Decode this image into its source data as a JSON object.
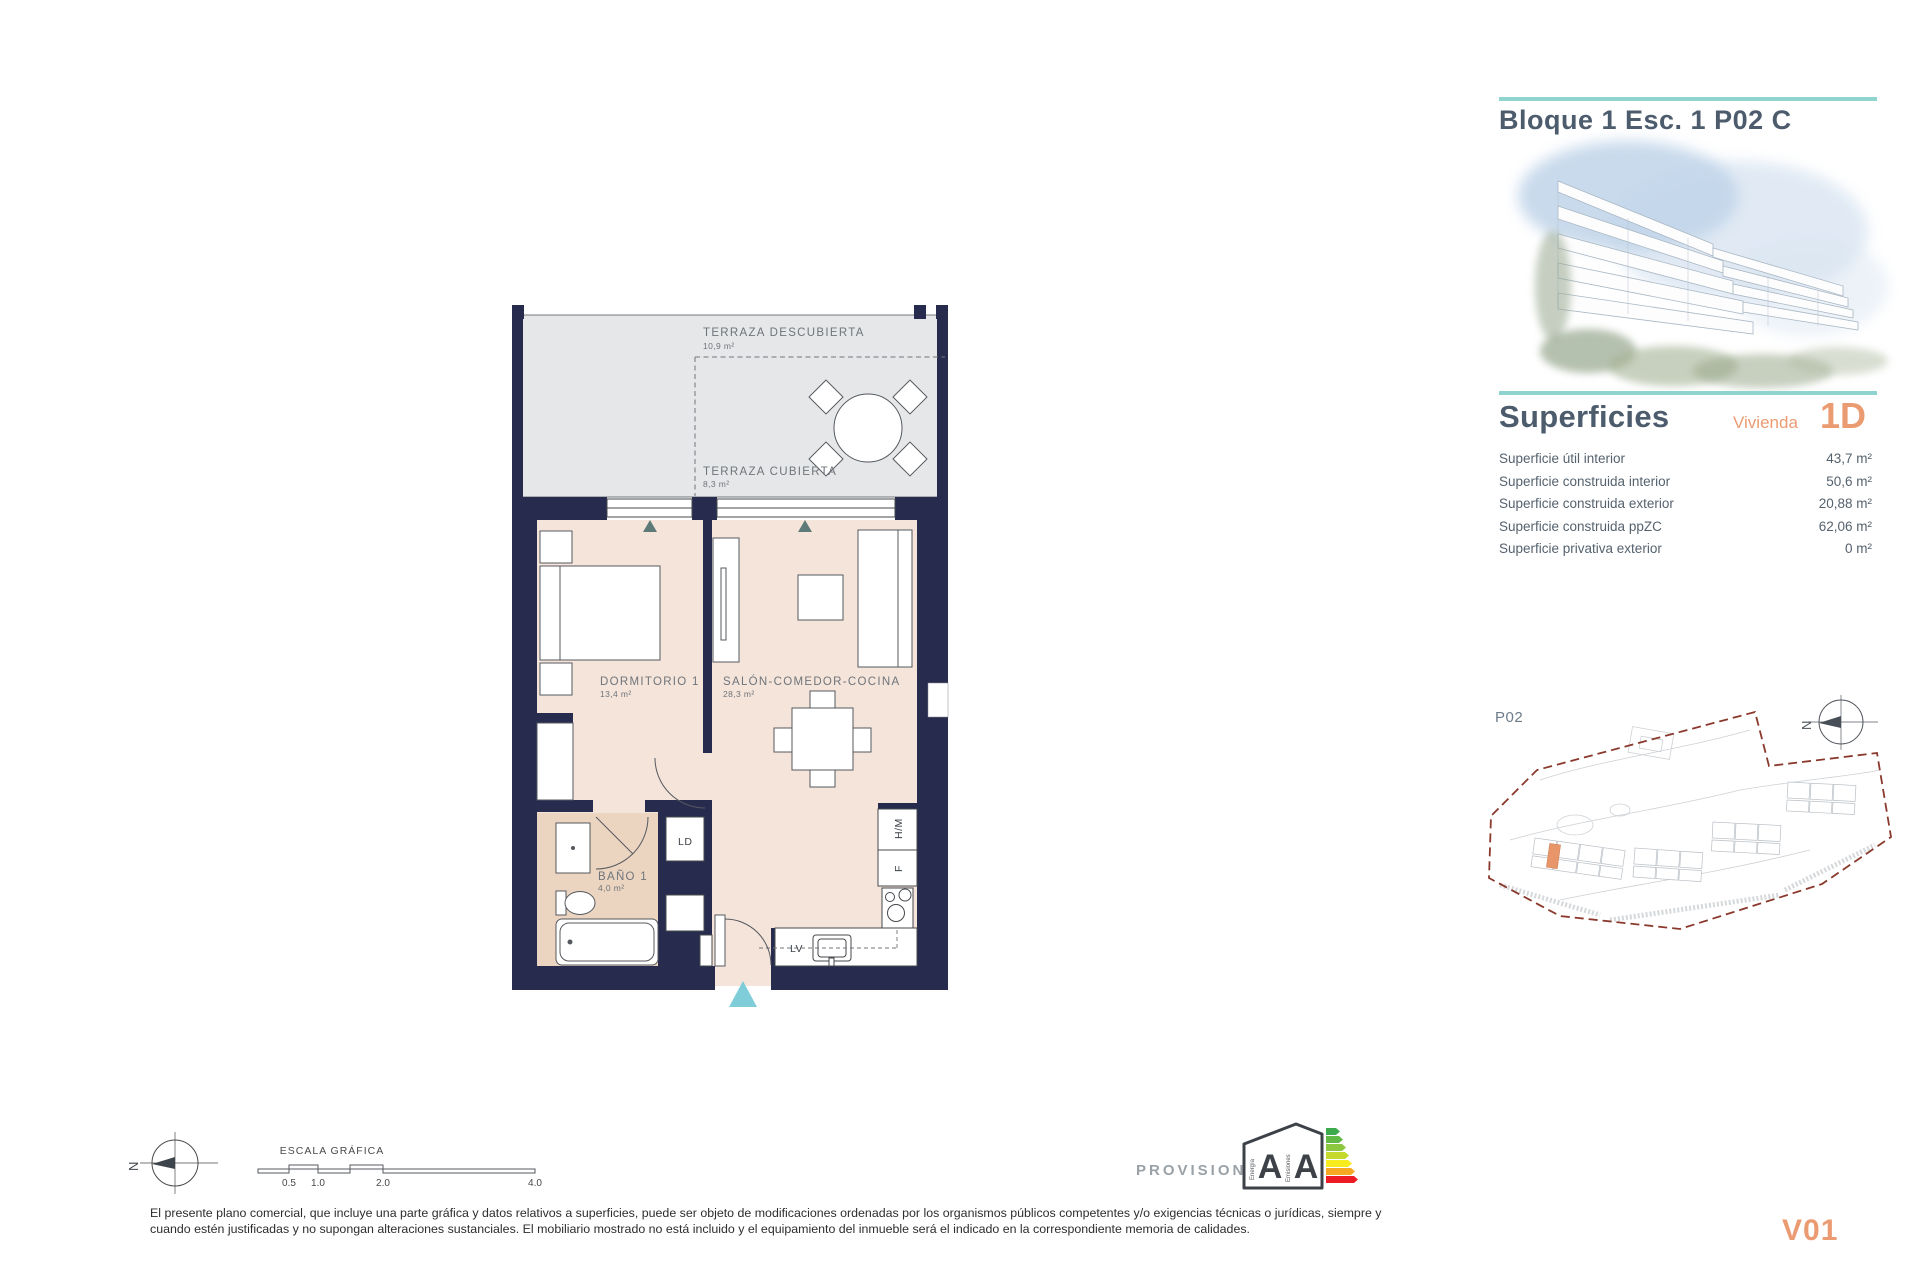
{
  "page": {
    "title_block": "Bloque 1 Esc. 1 P02 C",
    "version": "V01"
  },
  "superficies": {
    "heading": "Superficies",
    "vivienda_label": "Vivienda",
    "vivienda_code": "1D",
    "rows": [
      {
        "label": "Superficie útil interior",
        "value": "43,7 m²"
      },
      {
        "label": "Superficie construida interior",
        "value": "50,6 m²"
      },
      {
        "label": "Superficie construida exterior",
        "value": "20,88 m²"
      },
      {
        "label": "Superficie construida ppZC",
        "value": "62,06 m²"
      },
      {
        "label": "Superficie privativa exterior",
        "value": "0 m²"
      }
    ]
  },
  "floorplan": {
    "rooms": {
      "terraza_descubierta": {
        "name": "TERRAZA DESCUBIERTA",
        "area": "10,9 m²"
      },
      "terraza_cubierta": {
        "name": "TERRAZA CUBIERTA",
        "area": "8,3 m²"
      },
      "dormitorio": {
        "name": "DORMITORIO 1",
        "area": "13,4 m²"
      },
      "salon": {
        "name": "SALÓN-COMEDOR-COCINA",
        "area": "28,3 m²"
      },
      "bano": {
        "name": "BAÑO 1",
        "area": "4,0 m²"
      }
    },
    "labels": {
      "ld": "LD",
      "lv": "LV",
      "f": "F",
      "hm": "H/M"
    }
  },
  "siteplan": {
    "floor": "P02"
  },
  "scale": {
    "title": "ESCALA GRÁFICA",
    "ticks": [
      "0.5",
      "1.0",
      "2.0",
      "4.0"
    ]
  },
  "north_label": "N",
  "energy": {
    "status": "PROVISIONAL",
    "rating_energy": "A",
    "rating_emissions": "A",
    "axis_energy": "Energía",
    "axis_emissions": "Emisiones"
  },
  "disclaimer": {
    "line1": "El presente plano comercial, que incluye una parte gráfica y datos relativos a superficies, puede ser objeto de modificaciones ordenadas por los organismos públicos competentes y/o exigencias técnicas o jurídicas, siempre y",
    "line2": "cuando estén justificadas y no supongan alteraciones sustanciales. El mobiliario mostrado no está incluido y el equipamiento del inmueble será el indicado en la correspondiente memoria de calidades."
  },
  "colors": {
    "teal": "#8FD4CE",
    "orange": "#EB9B71",
    "wall_navy": "#272B4E",
    "heading": "#4D5C6D"
  }
}
